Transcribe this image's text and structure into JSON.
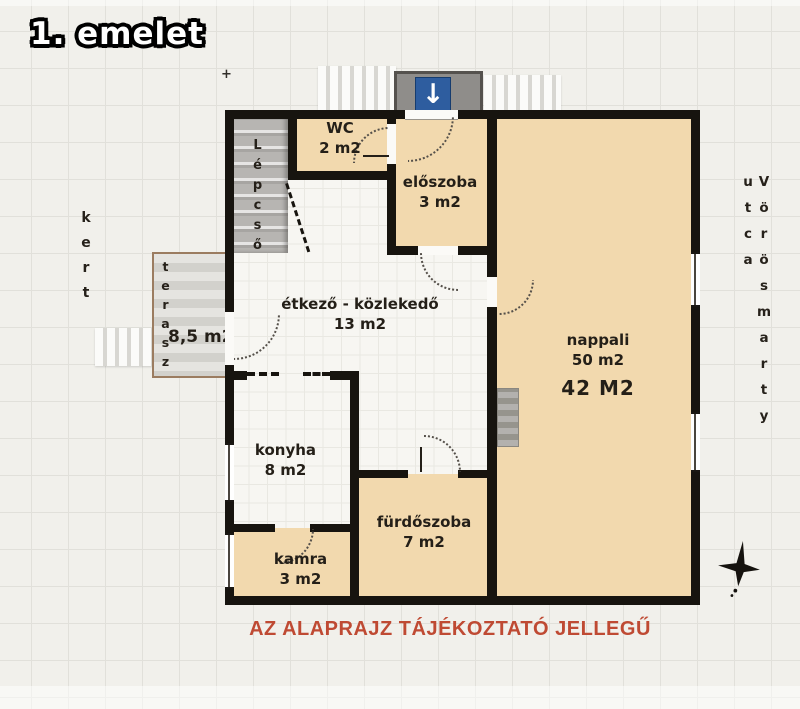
{
  "title": "1. emelet",
  "plan": {
    "rooms": {
      "lepcso": {
        "name": "Lépcső"
      },
      "wc": {
        "name": "WC",
        "area": "2 m2"
      },
      "eloszoba": {
        "name": "előszoba",
        "area": "3 m2"
      },
      "etkezo": {
        "name": "étkező - közlekedő",
        "area": "13 m2"
      },
      "nappali": {
        "name": "nappali",
        "area": "50 m2",
        "area_corrected": "42 M2"
      },
      "konyha": {
        "name": "konyha",
        "area": "8 m2"
      },
      "furdoszoba": {
        "name": "fürdőszoba",
        "area": "7 m2"
      },
      "kamra": {
        "name": "kamra",
        "area": "3 m2"
      },
      "terasz": {
        "name": "terasz",
        "area": "8,5 m2"
      }
    },
    "outside": {
      "garden_label": "kert",
      "street_label": "Vörösmarty utca"
    },
    "entrance_arrow": "↓",
    "disclaimer": "AZ ALAPRAJZ TÁJÉKOZTATÓ JELLEGŰ"
  },
  "colors": {
    "wall": "#17140f",
    "room_fill": "#f2d9ae",
    "floor_tile": "#f7f6f2",
    "terrace_border": "#9b7c60",
    "porch_fill": "#8f8d8a",
    "arrow_blue": "#2e5d9f",
    "disclaimer_red": "#bf4a33",
    "background": "#f1f0eb"
  }
}
